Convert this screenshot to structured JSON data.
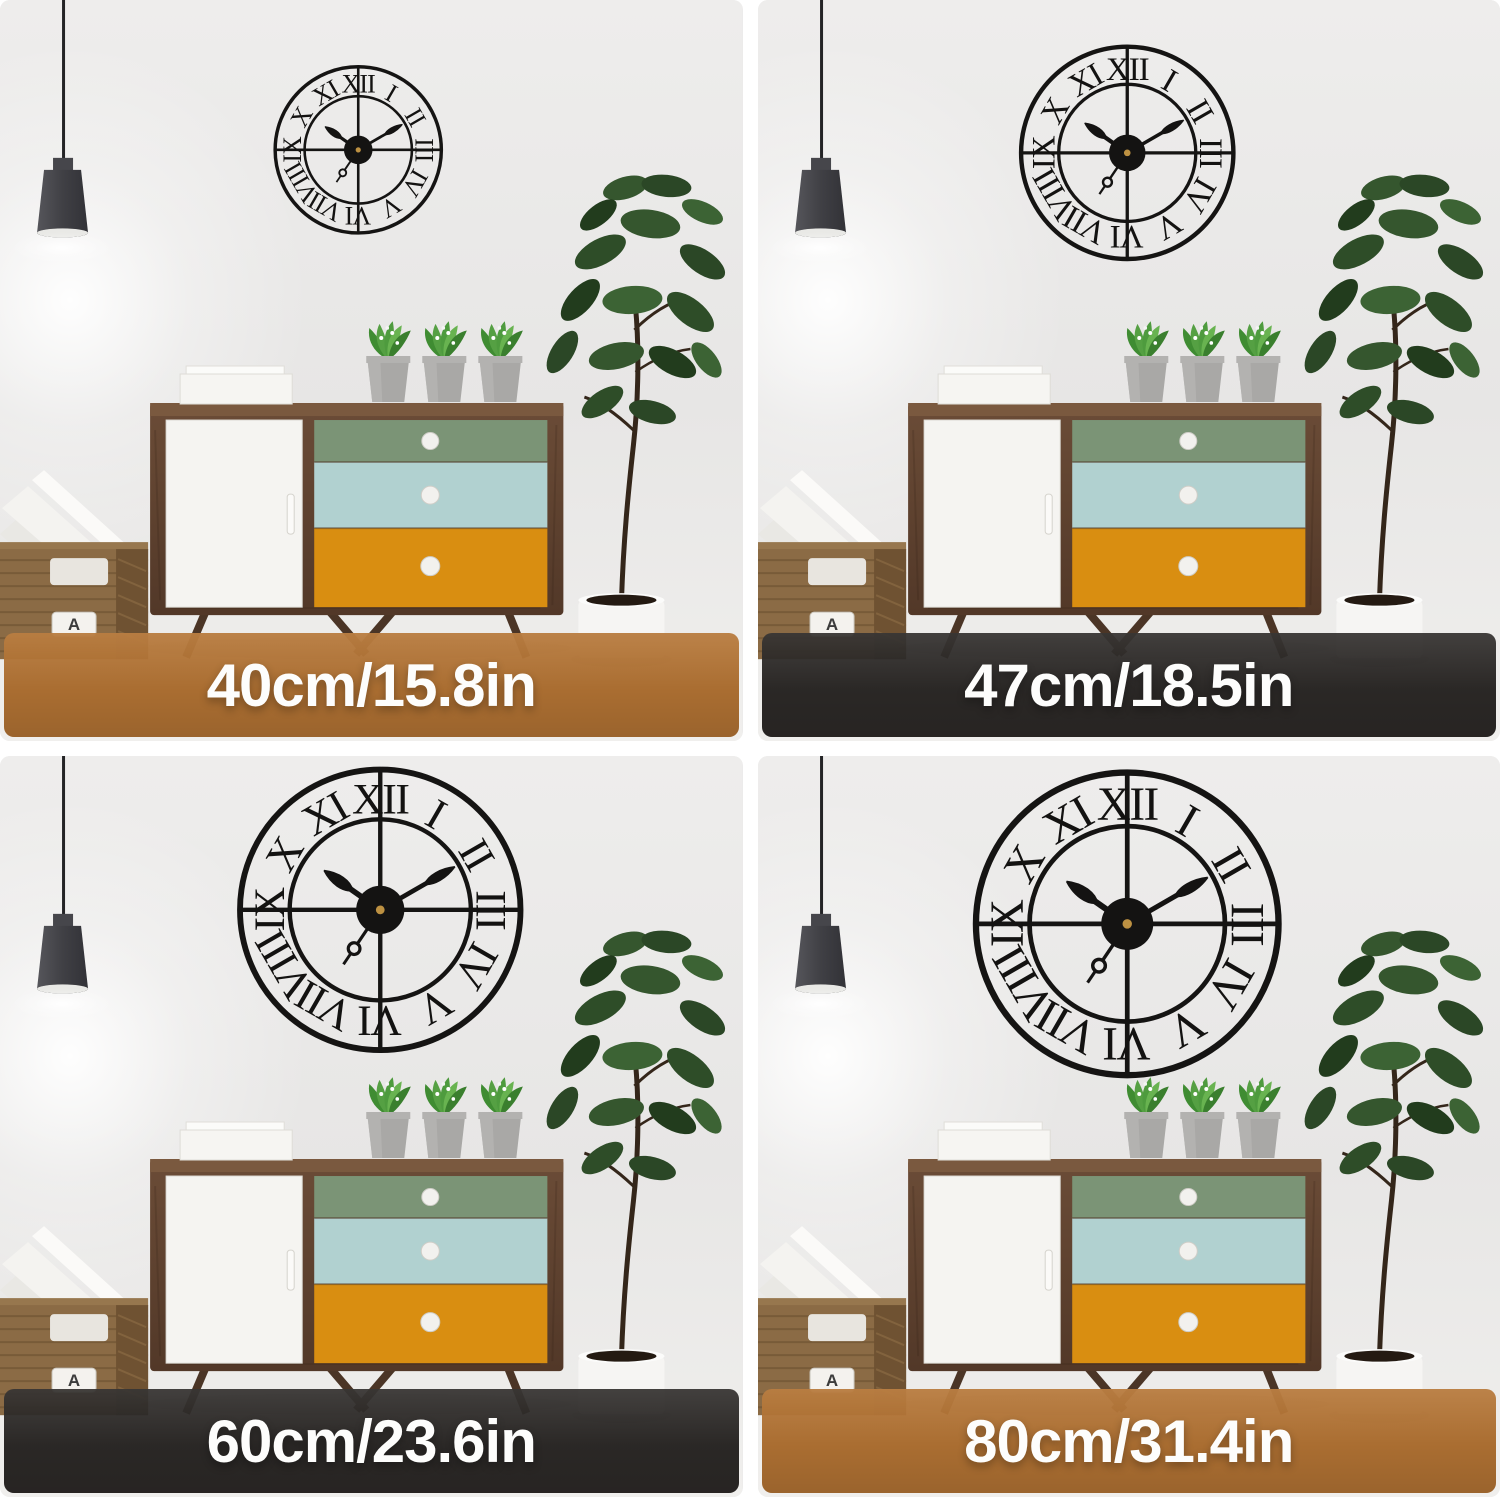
{
  "image_type": "wall clock size comparison product photo, 2x2 grid of identical room scenes",
  "quadrants": [
    {
      "id": "size-40cm",
      "label": "40cm/15.8in",
      "bar_color": "rgba(177,110,44,0.96)",
      "bar_color_hex": "#b16e2c",
      "clock": {
        "diameter": 173,
        "cx": 358,
        "cy": 150
      }
    },
    {
      "id": "size-47cm",
      "label": "47cm/18.5in",
      "bar_color": "rgba(33,30,28,0.94)",
      "bar_color_hex": "#211e1c",
      "clock": {
        "diameter": 221,
        "cx": 369,
        "cy": 153
      }
    },
    {
      "id": "size-60cm",
      "label": "60cm/23.6in",
      "bar_color": "rgba(33,30,28,0.94)",
      "bar_color_hex": "#211e1c",
      "clock": {
        "diameter": 292,
        "cx": 380,
        "cy": 154
      }
    },
    {
      "id": "size-80cm",
      "label": "80cm/31.4in",
      "bar_color": "rgba(177,110,44,0.96)",
      "bar_color_hex": "#b16e2c",
      "clock": {
        "diameter": 315,
        "cx": 369,
        "cy": 168
      }
    }
  ],
  "clock": {
    "style": "black metal skeleton wall clock with Roman numerals and cross spokes",
    "numerals": [
      "XII",
      "I",
      "II",
      "III",
      "IV",
      "V",
      "VI",
      "VII",
      "VIII",
      "IX",
      "X",
      "XI"
    ],
    "time_shown": "10:10",
    "hour_angle_deg": 305,
    "minute_angle_deg": 60,
    "second_angle_deg": 214,
    "metal_color": "#151413",
    "hub_pin_color": "#bd9142"
  },
  "basket": {
    "label": "A"
  },
  "palette": {
    "page_bg": "#ffffff",
    "wall": "#ebeaea",
    "label_text": "#fdfdfc",
    "drawer_green": "#7b9476",
    "drawer_blue": "#b1d1d0",
    "drawer_orange": "#d98e11",
    "cabinet_wood": "#5d4232",
    "lamp_shade": "#3f3f44",
    "fig_leaf_green": "#2e4d28",
    "small_plant_green": "#4e9b3e",
    "pot_white": "#f6f5f3",
    "pot_concrete": "#a9a8a6",
    "basket_wicker": "#8b6b45"
  }
}
